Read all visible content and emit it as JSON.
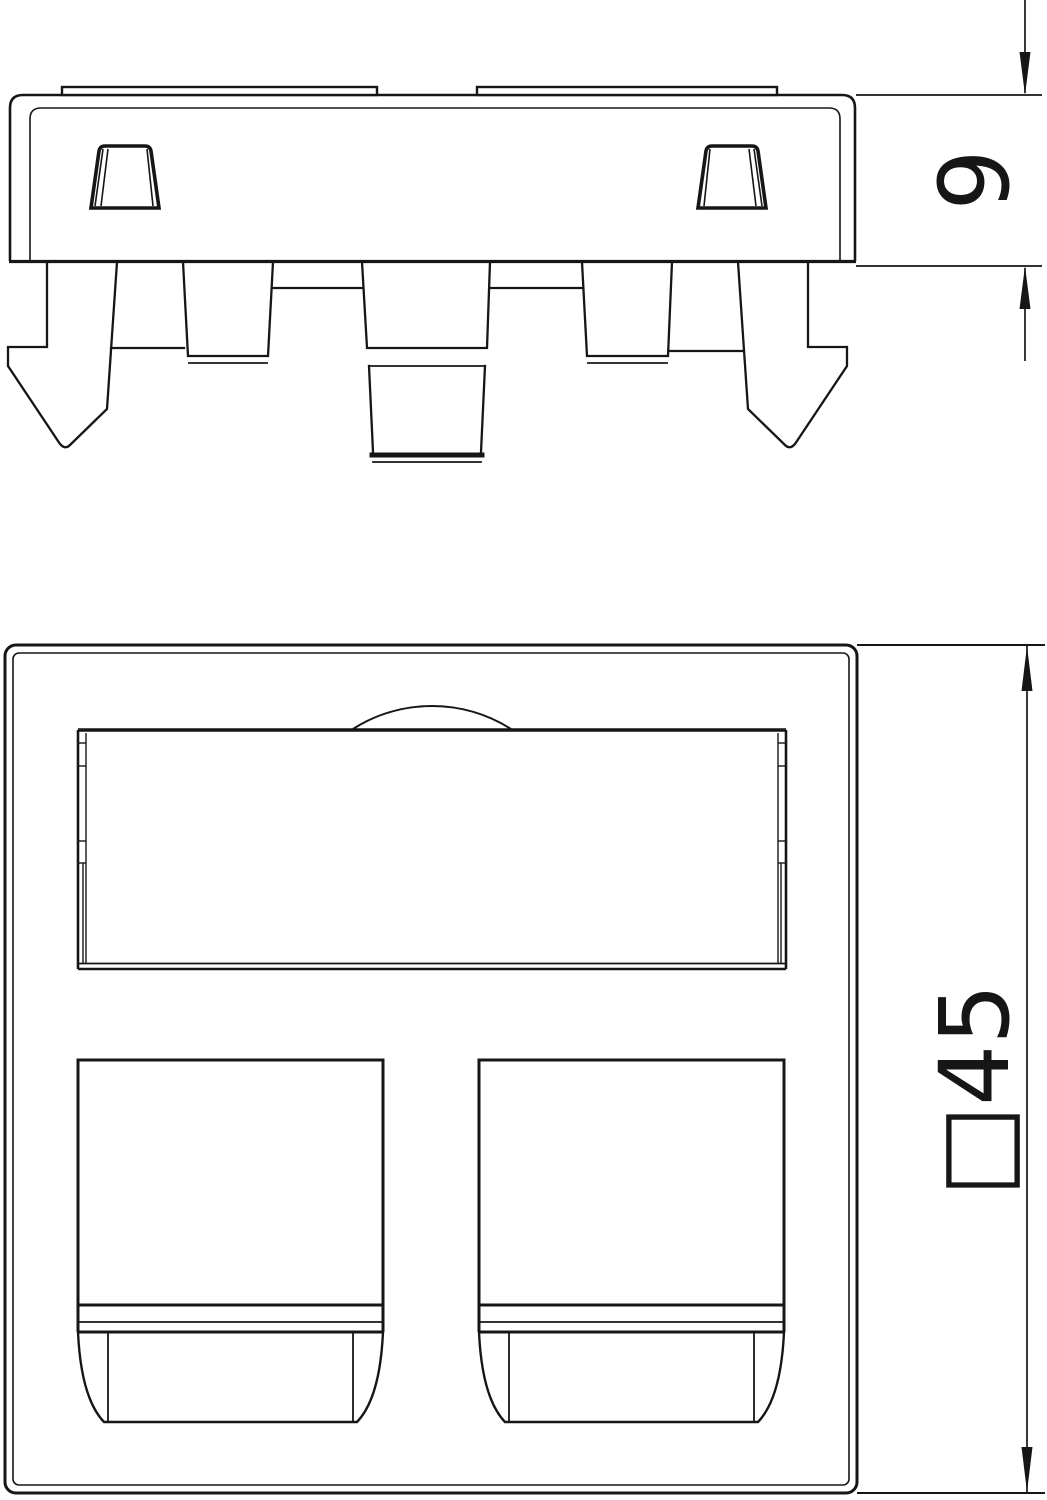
{
  "page": {
    "background": "#ffffff",
    "ink": "#161616",
    "description_side_view": "side profile of device plate with mounting claws",
    "description_front_view": "front face with label field and two jack openings"
  },
  "views": {
    "side": {
      "depth_dimension": "9"
    },
    "front": {
      "size_dimension": "□45"
    }
  }
}
